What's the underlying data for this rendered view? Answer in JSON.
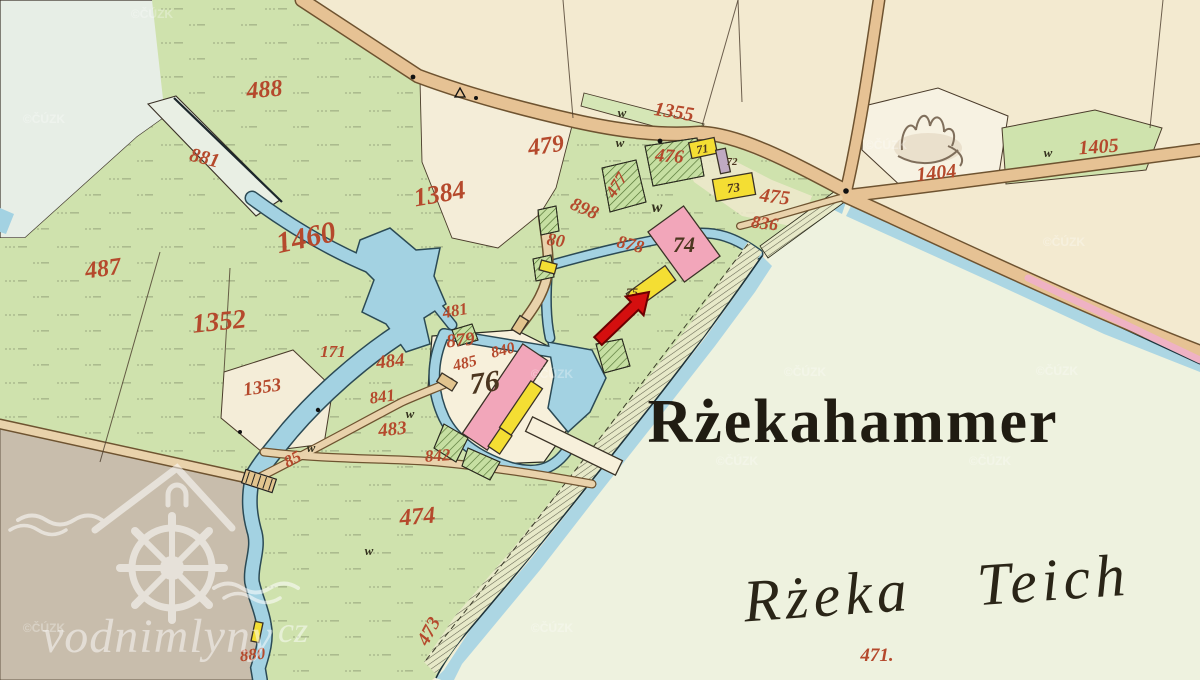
{
  "map": {
    "title": "Rżekahammer",
    "subtitle": "Rżeka Teich",
    "watermark": {
      "text": "vodnimlyny",
      "tld": "cz",
      "copyright": "©ČÚZK"
    },
    "palette": {
      "paper_cream": "#f3ead0",
      "meadow_green": "#cfe2ad",
      "pond_pale": "#eef2df",
      "water_blue": "#a3d2e2",
      "road_tan": "#e6c294",
      "road_pink_stripe": "#efb2c4",
      "field_grey": "#c8bdac",
      "building_pink": "#f2a6ba",
      "building_yellow": "#f4de33",
      "building_grey": "#bfaac2",
      "garden_green": "#c6dfa2",
      "label_red": "#b5492c",
      "label_brown": "#4c3620",
      "arrow_red": "#d40f0f"
    },
    "parcel_labels": [
      {
        "t": "488",
        "x": 265,
        "y": 97,
        "s": 24,
        "r": -5,
        "c": "red"
      },
      {
        "t": "881",
        "x": 203,
        "y": 164,
        "s": 20,
        "r": 14,
        "c": "red"
      },
      {
        "t": "1460",
        "x": 308,
        "y": 247,
        "s": 30,
        "r": -12,
        "c": "red"
      },
      {
        "t": "487",
        "x": 104,
        "y": 276,
        "s": 24,
        "r": -8,
        "c": "red"
      },
      {
        "t": "1352",
        "x": 220,
        "y": 330,
        "s": 27,
        "r": -6,
        "c": "red"
      },
      {
        "t": "1353",
        "x": 263,
        "y": 393,
        "s": 19,
        "r": -8,
        "c": "red"
      },
      {
        "t": "1384",
        "x": 441,
        "y": 202,
        "s": 26,
        "r": -10,
        "c": "red"
      },
      {
        "t": "479",
        "x": 547,
        "y": 153,
        "s": 24,
        "r": -8,
        "c": "red"
      },
      {
        "t": "1355",
        "x": 673,
        "y": 118,
        "s": 20,
        "r": 9,
        "c": "red"
      },
      {
        "t": "476",
        "x": 669,
        "y": 162,
        "s": 19,
        "r": 4,
        "c": "red"
      },
      {
        "t": "477",
        "x": 621,
        "y": 188,
        "s": 17,
        "r": -58,
        "c": "red"
      },
      {
        "t": "898",
        "x": 582,
        "y": 214,
        "s": 19,
        "r": 24,
        "c": "red"
      },
      {
        "t": "80",
        "x": 555,
        "y": 246,
        "s": 18,
        "r": 8,
        "c": "red"
      },
      {
        "t": "878",
        "x": 629,
        "y": 250,
        "s": 18,
        "r": 14,
        "c": "red"
      },
      {
        "t": "475",
        "x": 774,
        "y": 203,
        "s": 20,
        "r": 7,
        "c": "red"
      },
      {
        "t": "836",
        "x": 764,
        "y": 229,
        "s": 18,
        "r": 7,
        "c": "red"
      },
      {
        "t": "1404",
        "x": 937,
        "y": 179,
        "s": 20,
        "r": -6,
        "c": "red"
      },
      {
        "t": "1405",
        "x": 1099,
        "y": 153,
        "s": 20,
        "r": -4,
        "c": "red"
      },
      {
        "t": "481",
        "x": 456,
        "y": 316,
        "s": 17,
        "r": -10,
        "c": "red"
      },
      {
        "t": "879",
        "x": 461,
        "y": 346,
        "s": 19,
        "r": -6,
        "c": "red"
      },
      {
        "t": "485",
        "x": 466,
        "y": 368,
        "s": 16,
        "r": -14,
        "c": "red"
      },
      {
        "t": "840",
        "x": 504,
        "y": 355,
        "s": 16,
        "r": -14,
        "c": "red"
      },
      {
        "t": "171",
        "x": 333,
        "y": 357,
        "s": 17,
        "r": 0,
        "c": "red"
      },
      {
        "t": "484",
        "x": 391,
        "y": 367,
        "s": 19,
        "r": -6,
        "c": "red"
      },
      {
        "t": "841",
        "x": 383,
        "y": 402,
        "s": 17,
        "r": -8,
        "c": "red"
      },
      {
        "t": "483",
        "x": 393,
        "y": 435,
        "s": 19,
        "r": -6,
        "c": "red"
      },
      {
        "t": "842",
        "x": 438,
        "y": 461,
        "s": 17,
        "r": -4,
        "c": "red"
      },
      {
        "t": "85",
        "x": 295,
        "y": 464,
        "s": 17,
        "r": -28,
        "c": "red"
      },
      {
        "t": "474",
        "x": 418,
        "y": 524,
        "s": 24,
        "r": -5,
        "c": "red"
      },
      {
        "t": "473",
        "x": 434,
        "y": 634,
        "s": 19,
        "r": -62,
        "c": "red"
      },
      {
        "t": "880",
        "x": 253,
        "y": 660,
        "s": 17,
        "r": -6,
        "c": "red"
      },
      {
        "t": "471.",
        "x": 877,
        "y": 661,
        "s": 19,
        "r": 0,
        "c": "red"
      },
      {
        "t": "71",
        "x": 703,
        "y": 153,
        "s": 12,
        "r": -10,
        "c": "brown"
      },
      {
        "t": "72",
        "x": 732,
        "y": 165,
        "s": 11,
        "r": 0,
        "c": "brown"
      },
      {
        "t": "73",
        "x": 734,
        "y": 192,
        "s": 13,
        "r": -8,
        "c": "brown"
      },
      {
        "t": "74",
        "x": 684,
        "y": 252,
        "s": 22,
        "r": 0,
        "c": "brown"
      },
      {
        "t": "75",
        "x": 632,
        "y": 296,
        "s": 12,
        "r": 0,
        "c": "brown"
      },
      {
        "t": "76",
        "x": 486,
        "y": 392,
        "s": 30,
        "r": -8,
        "c": "brown"
      }
    ],
    "w_marks": [
      {
        "x": 622,
        "y": 117,
        "s": 13
      },
      {
        "x": 620,
        "y": 147,
        "s": 13
      },
      {
        "x": 657,
        "y": 212,
        "s": 16
      },
      {
        "x": 1048,
        "y": 157,
        "s": 13
      },
      {
        "x": 311,
        "y": 452,
        "s": 13
      },
      {
        "x": 369,
        "y": 555,
        "s": 13
      },
      {
        "x": 410,
        "y": 418,
        "s": 13
      }
    ],
    "copyright_positions": [
      {
        "x": 20,
        "y": 115
      },
      {
        "x": 128,
        "y": 10
      },
      {
        "x": 862,
        "y": 141
      },
      {
        "x": 1040,
        "y": 238
      },
      {
        "x": 528,
        "y": 370
      },
      {
        "x": 781,
        "y": 368
      },
      {
        "x": 1033,
        "y": 367
      },
      {
        "x": 713,
        "y": 457
      },
      {
        "x": 966,
        "y": 457
      },
      {
        "x": 528,
        "y": 624
      },
      {
        "x": 20,
        "y": 624
      }
    ]
  }
}
